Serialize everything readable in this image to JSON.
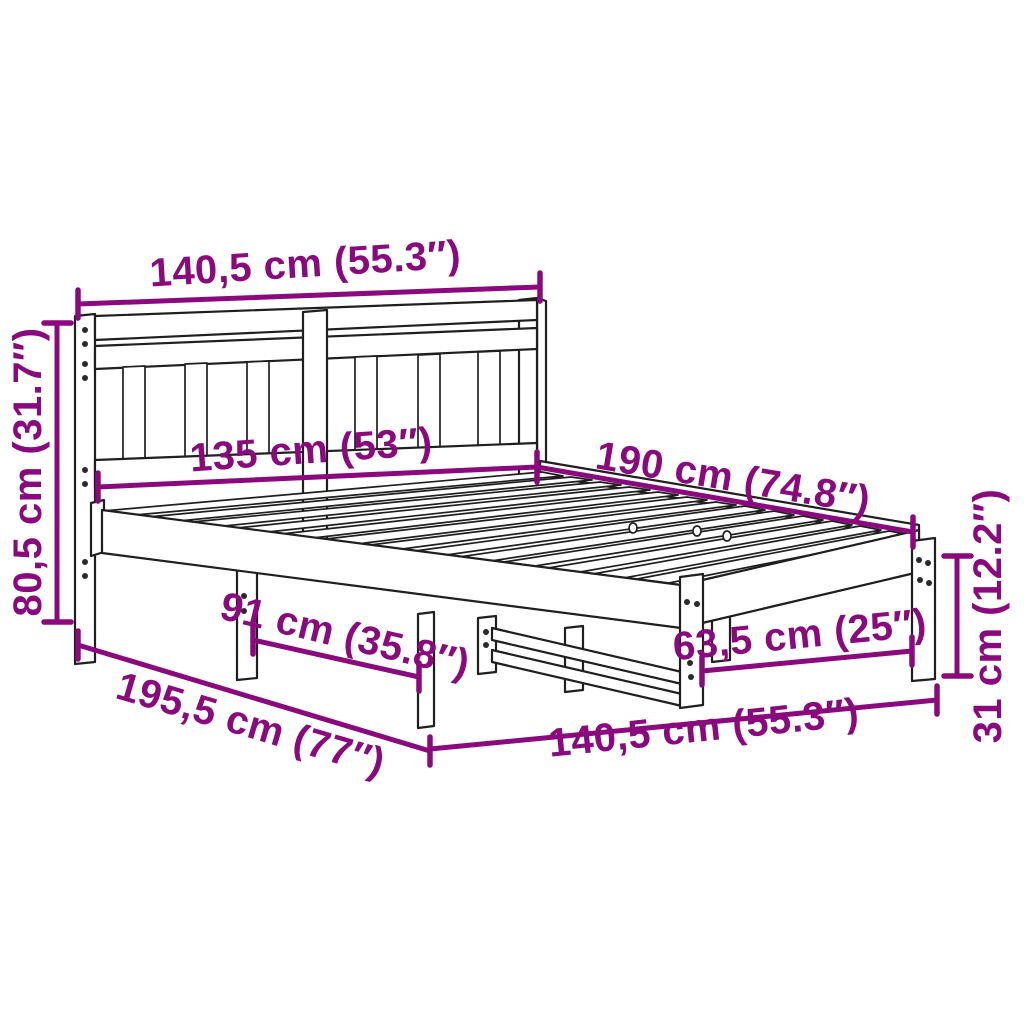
{
  "style": {
    "accent": "#8a0a7e",
    "line": "#1f1f1f",
    "bg": "#ffffff"
  },
  "diagram": {
    "type": "product-dimension-diagram",
    "subject": "wooden bed frame with slatted headboard and slatted base",
    "dimensions": {
      "top_width": "140,5 cm (55.3″)",
      "headboard_height": "80,5 cm (31.7″)",
      "headboard_inner_width": "135 cm (53″)",
      "mattress_length": "190 cm (74.8″)",
      "side_inner_length": "91 cm (35.8″)",
      "total_length": "195,5 cm (77″)",
      "bottom_width": "140,5 cm (55.3″)",
      "foot_inner_width": "63,5 cm (25″)",
      "frame_height": "31 cm (12.2″)"
    }
  }
}
